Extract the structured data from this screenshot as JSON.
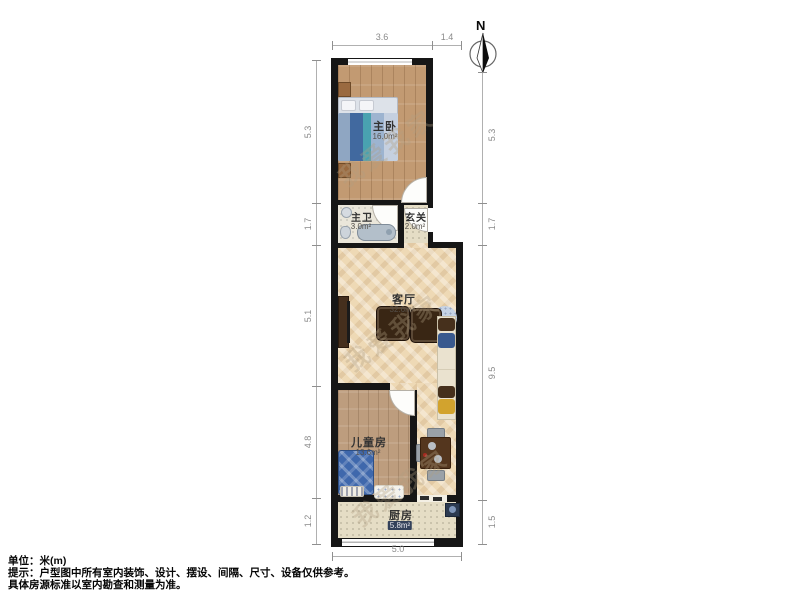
{
  "compass": {
    "north_label": "N"
  },
  "rooms": {
    "master": {
      "name": "主卧",
      "area": "16.0m²"
    },
    "bath": {
      "name": "主卫",
      "area": "3.0m²"
    },
    "entry": {
      "name": "玄关",
      "area": "2.0m²"
    },
    "living": {
      "name": "客厅",
      "area": "32.6m²"
    },
    "kids": {
      "name": "儿童房",
      "area": "13.6m²"
    },
    "kitchen": {
      "name": "厨房",
      "area": "5.8m²"
    }
  },
  "dimensions": {
    "unit": "米",
    "top": {
      "seg1": "3.6",
      "seg2": "1.4"
    },
    "bottom": {
      "seg1": "5.0"
    },
    "left": {
      "seg1": "5.3",
      "seg2": "1.7",
      "seg3": "5.1",
      "seg4": "4.8",
      "seg5": "1.2"
    },
    "right": {
      "seg1": "5.3",
      "seg2": "1.7",
      "seg3": "9.5",
      "seg4": "1.5"
    }
  },
  "footer": {
    "unit_line": "单位：米(m)",
    "tip_line1": "提示：户型图中所有室内装饰、设计、摆设、间隔、尺寸、设备仅供参考。",
    "tip_line2": "具体房源标准以室内勘查和测量为准。"
  },
  "watermark": {
    "text": "我爱我家"
  },
  "colors": {
    "wall": "#161616",
    "wood_floor": "#c29a72",
    "herringbone_floor": "#eed9b5",
    "tile_floor": "#eae6da",
    "bed_blue": "#3f68ac",
    "sofa_cream": "#eae2cf"
  }
}
